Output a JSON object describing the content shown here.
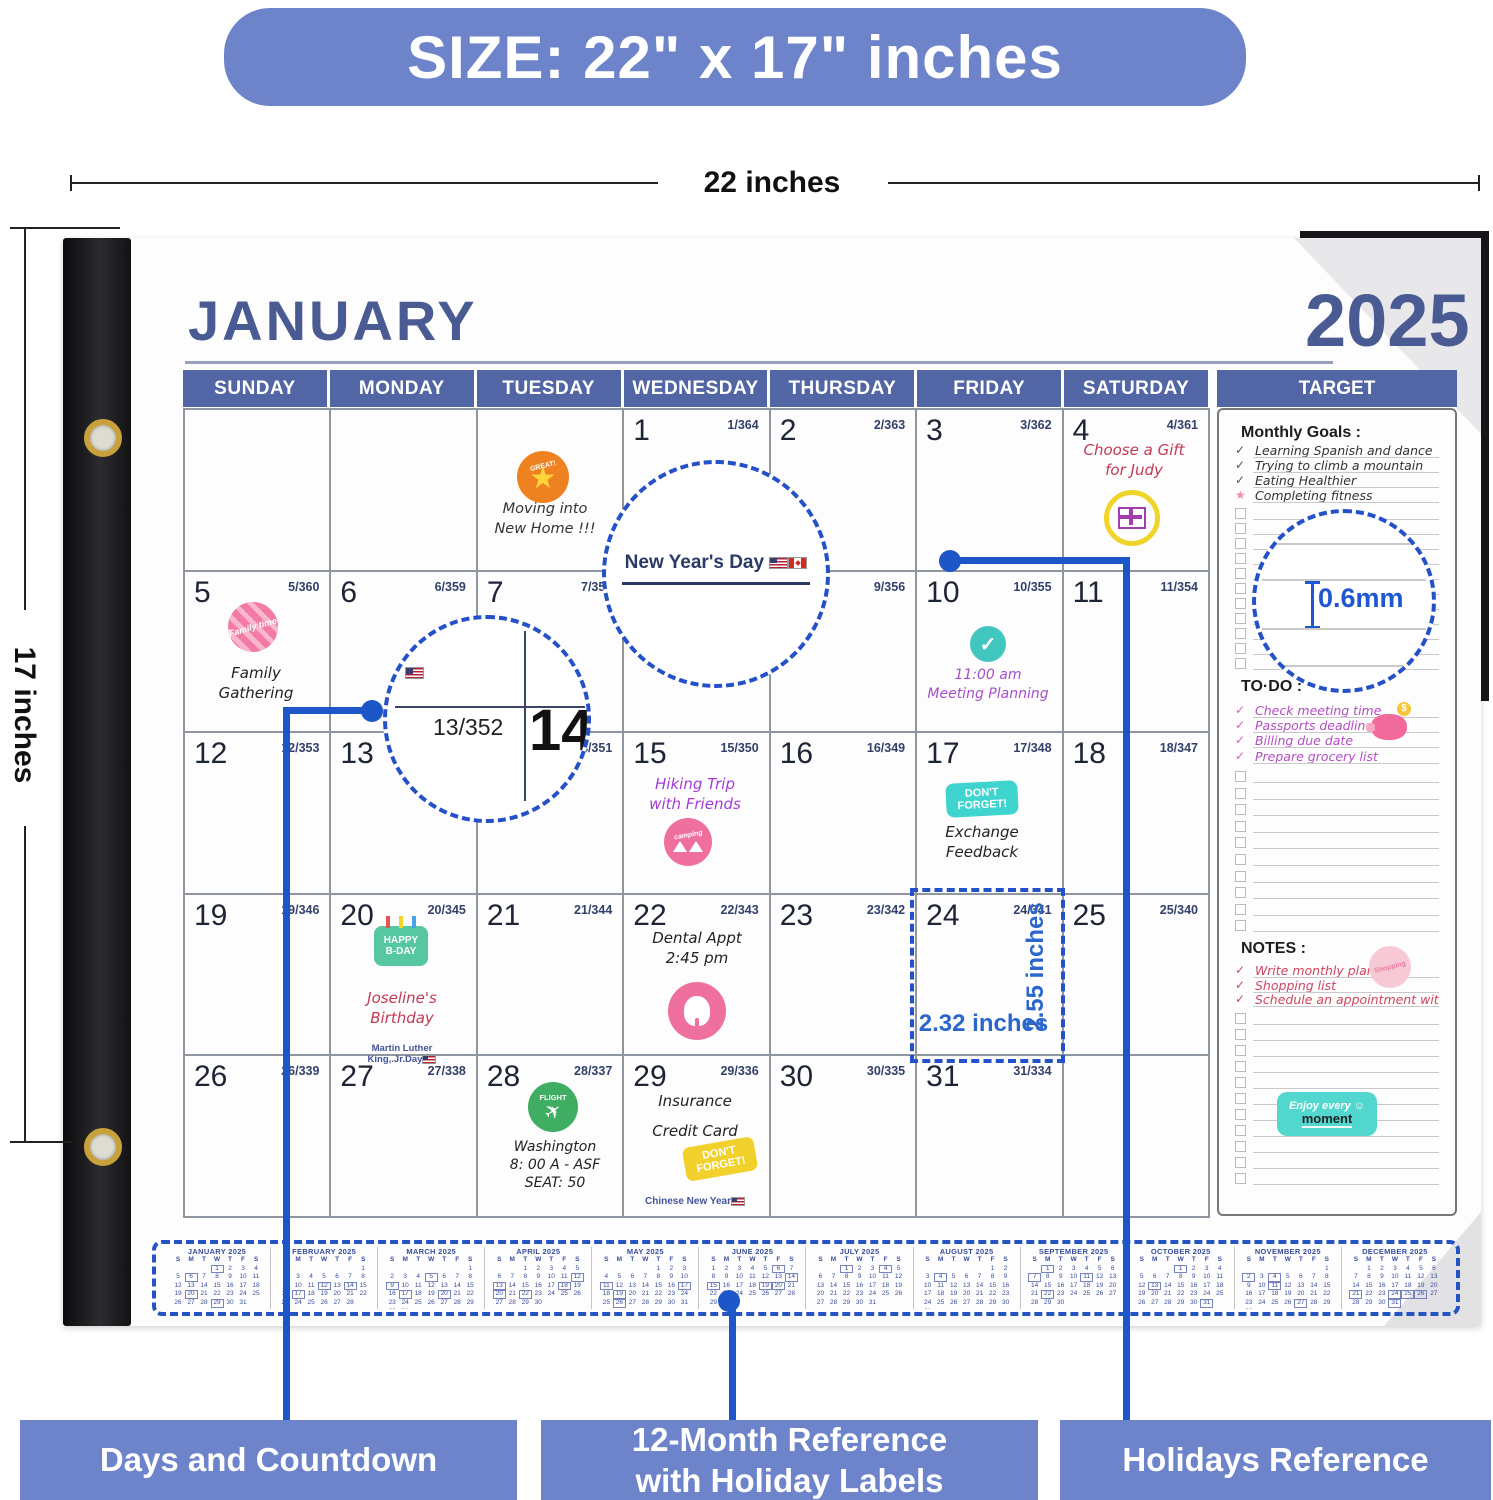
{
  "banner": {
    "size_label": "SIZE: 22\" x 17\" inches"
  },
  "dimensions": {
    "width_label": "22 inches",
    "height_label": "17 inches",
    "cell_width": "2.32 inches",
    "cell_height": "2.55 inches",
    "paper_thickness": "0.6mm"
  },
  "colors": {
    "accent_blue": "#6d84cb",
    "header_blue": "#5265a4",
    "title_blue": "#4a5b94",
    "dashed_blue": "#2450c8",
    "callout_blue": "#1d56c8"
  },
  "calendar": {
    "month_title": "JANUARY",
    "year": "2025",
    "day_headers": [
      "SUNDAY",
      "MONDAY",
      "TUESDAY",
      "WEDNESDAY",
      "THURSDAY",
      "FRIDAY",
      "SATURDAY"
    ],
    "target_header": "TARGET",
    "weeks": [
      [
        null,
        null,
        null,
        {
          "d": "1",
          "c": "1/364"
        },
        {
          "d": "2",
          "c": "2/363"
        },
        {
          "d": "3",
          "c": "3/362"
        },
        {
          "d": "4",
          "c": "4/361"
        }
      ],
      [
        {
          "d": "5",
          "c": "5/360"
        },
        {
          "d": "6",
          "c": "6/359"
        },
        {
          "d": "7",
          "c": "7/358"
        },
        {
          "d": "8",
          "c": "8/357"
        },
        {
          "d": "9",
          "c": "9/356"
        },
        {
          "d": "10",
          "c": "10/355"
        },
        {
          "d": "11",
          "c": "11/354"
        }
      ],
      [
        {
          "d": "12",
          "c": "12/353"
        },
        {
          "d": "13",
          "c": "13/352"
        },
        {
          "d": "14",
          "c": "14/351"
        },
        {
          "d": "15",
          "c": "15/350"
        },
        {
          "d": "16",
          "c": "16/349"
        },
        {
          "d": "17",
          "c": "17/348"
        },
        {
          "d": "18",
          "c": "18/347"
        }
      ],
      [
        {
          "d": "19",
          "c": "19/346"
        },
        {
          "d": "20",
          "c": "20/345"
        },
        {
          "d": "21",
          "c": "21/344"
        },
        {
          "d": "22",
          "c": "22/343"
        },
        {
          "d": "23",
          "c": "23/342"
        },
        {
          "d": "24",
          "c": "24/341"
        },
        {
          "d": "25",
          "c": "25/340"
        }
      ],
      [
        {
          "d": "26",
          "c": "26/339"
        },
        {
          "d": "27",
          "c": "27/338"
        },
        {
          "d": "28",
          "c": "28/337"
        },
        {
          "d": "29",
          "c": "29/336"
        },
        {
          "d": "30",
          "c": "30/335"
        },
        {
          "d": "31",
          "c": "31/334"
        },
        null
      ]
    ]
  },
  "events": {
    "moving": {
      "sticker": "GREAT!",
      "text": "Moving into\nNew Home !!!"
    },
    "new_years": {
      "label": "New Year's Day"
    },
    "gift": {
      "text": "Choose a Gift\nfor Judy"
    },
    "family": {
      "sticker": "Family time",
      "text": "Family\nGathering"
    },
    "meeting": {
      "text": "11:00 am\nMeeting Planning"
    },
    "hiking": {
      "text": "Hiking Trip\nwith Friends",
      "sticker": "camping"
    },
    "exchange": {
      "sticker": "DON'T\nFORGET!",
      "text": "Exchange\nFeedback"
    },
    "birthday": {
      "sticker": "HAPPY\nB-DAY",
      "text": "Joseline's\nBirthday",
      "holiday": "Martin Luther\nKing,.Jr.Day"
    },
    "dental": {
      "text": "Dental Appt\n2:45 pm"
    },
    "flight": {
      "sticker": "FLIGHT",
      "text": "Washington\n8: 00 A - ASF\nSEAT: 50"
    },
    "insurance": {
      "text": "Insurance\n\nCredit Card",
      "sticker": "DON'T\nFORGET!",
      "holiday": "Chinese New Year"
    }
  },
  "magnifiers": {
    "countdown": "13/352",
    "big_day": "14",
    "thickness": "0.6mm"
  },
  "target_panel": {
    "monthly_goals_title": "Monthly Goals :",
    "monthly_goals": [
      "Learning Spanish and dance",
      "Trying to climb a mountain",
      "Eating Healthier",
      "Completing fitness"
    ],
    "goals_empty_rows": 11,
    "todo_title": "TO·DO :",
    "todo_items": [
      "Check meeting time",
      "Passports deadline",
      "Billing due date",
      "Prepare grocery list"
    ],
    "todo_empty_rows": 10,
    "notes_title": "NOTES :",
    "notes_items": [
      "Write monthly plan",
      "Shopping list",
      "Schedule an appointment with a dentist"
    ],
    "notes_empty_rows": 11,
    "enjoy_sticker": {
      "line1": "Enjoy every",
      "line2": "moment",
      "smiley": "☺"
    },
    "shopping_sticker": "Shopping"
  },
  "mini_months": [
    {
      "title": "JANUARY 2025",
      "dow": "SMTWTFS",
      "first": 3,
      "days": 31,
      "boxed": [
        1,
        6,
        20,
        29
      ]
    },
    {
      "title": "FEBRUARY 2025",
      "dow": "SMTWTFS",
      "first": 6,
      "days": 28,
      "boxed": [
        12,
        14,
        17
      ]
    },
    {
      "title": "MARCH 2025",
      "dow": "SMTWTFS",
      "first": 6,
      "days": 31,
      "boxed": [
        5,
        9,
        17,
        20
      ]
    },
    {
      "title": "APRIL 2025",
      "dow": "SMTWTFS",
      "first": 2,
      "days": 30,
      "boxed": [
        12,
        13,
        18,
        20,
        22
      ]
    },
    {
      "title": "MAY 2025",
      "dow": "SMTWTFS",
      "first": 4,
      "days": 31,
      "boxed": [
        11,
        17,
        19,
        26
      ]
    },
    {
      "title": "JUNE 2025",
      "dow": "SMTWTFS",
      "first": 0,
      "days": 30,
      "boxed": [
        6,
        14,
        15,
        19,
        20
      ]
    },
    {
      "title": "JULY 2025",
      "dow": "SMTWTFS",
      "first": 2,
      "days": 31,
      "boxed": [
        1,
        4
      ]
    },
    {
      "title": "AUGUST 2025",
      "dow": "SMTWTFS",
      "first": 5,
      "days": 31,
      "boxed": [
        4
      ]
    },
    {
      "title": "SEPTEMBER 2025",
      "dow": "SMTWTFS",
      "first": 1,
      "days": 30,
      "boxed": [
        1,
        7,
        11,
        22
      ]
    },
    {
      "title": "OCTOBER 2025",
      "dow": "SMTWTFS",
      "first": 3,
      "days": 31,
      "boxed": [
        1,
        13,
        31
      ]
    },
    {
      "title": "NOVEMBER 2025",
      "dow": "SMTWTFS",
      "first": 6,
      "days": 30,
      "boxed": [
        2,
        4,
        11,
        27
      ]
    },
    {
      "title": "DECEMBER 2025",
      "dow": "SMTWTFS",
      "first": 1,
      "days": 31,
      "boxed": [
        21,
        24,
        25,
        26,
        31
      ]
    }
  ],
  "callouts": {
    "box1": "Days and Countdown",
    "box2": "12-Month Reference\nwith Holiday Labels",
    "box3": "Holidays Reference"
  }
}
